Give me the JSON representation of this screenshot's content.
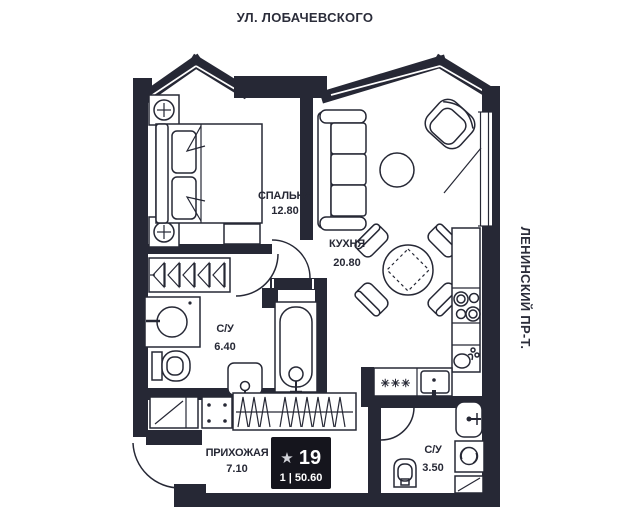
{
  "streets": {
    "top": "УЛ. ЛОБАЧЕВСКОГО",
    "right": "ЛЕНИНСКИЙ ПР-Т."
  },
  "rooms": {
    "bedroom": {
      "name": "СПАЛЬНЯ",
      "area": "12.80"
    },
    "kitchen": {
      "name": "КУХНЯ",
      "area": "20.80"
    },
    "bathroom_large": {
      "name": "С/У",
      "area": "6.40"
    },
    "bathroom_small": {
      "name": "С/У",
      "area": "3.50"
    },
    "hallway": {
      "name": "ПРИХОЖАЯ",
      "area": "7.10"
    }
  },
  "badge": {
    "star": "★",
    "apartment_number": "19",
    "info_line": "1 | 50.60"
  },
  "symbols": {
    "freezer": "✳✳✳"
  },
  "colors": {
    "ink": "#262835",
    "badge_bg": "#15151d",
    "badge_text": "#ffffff",
    "star": "#d2d3d9",
    "bg": "#ffffff"
  }
}
